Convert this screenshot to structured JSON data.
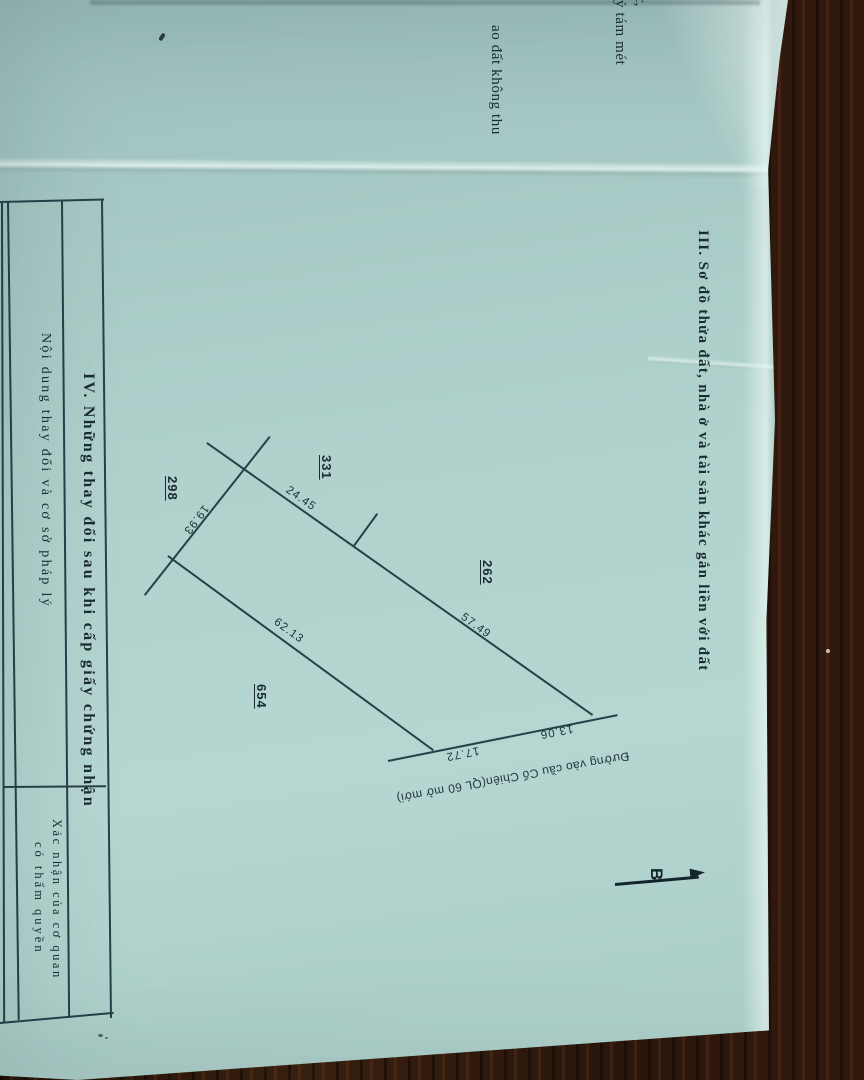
{
  "photo": {
    "colors": {
      "paper": "#aed0cb",
      "wood": "#2b1811",
      "ink": "#1a2b33"
    }
  },
  "fragments": {
    "frag_comma": "c,",
    "frag_tam_met": "ỷ tám mét",
    "frag_ao_dat": "ao đất không thu"
  },
  "section3": {
    "heading": "III. Sơ đồ thửa đất, nhà ở và tài sản khác gắn liền với đất"
  },
  "diagram": {
    "parcels": {
      "p331": "331",
      "p298": "298",
      "p262": "262",
      "p654": "654"
    },
    "dims": {
      "d2445": "24.45",
      "d1993": "19.93",
      "d5749": "57.49",
      "d6213": "62.13",
      "d1772": "17.72",
      "d1306": "13.06"
    },
    "road_label": "Đường vào cầu Cổ Chiên(QL 60 mở mới)",
    "north_label": "B"
  },
  "section4": {
    "title": "IV. Những thay đổi sau khi cấp giấy chứng nhận",
    "col_content_header": "Nội dung thay đổi và cơ sở pháp lý",
    "col_confirm_line1": "Xác nhận của cơ quan",
    "col_confirm_line2": "có thẩm quyền"
  }
}
